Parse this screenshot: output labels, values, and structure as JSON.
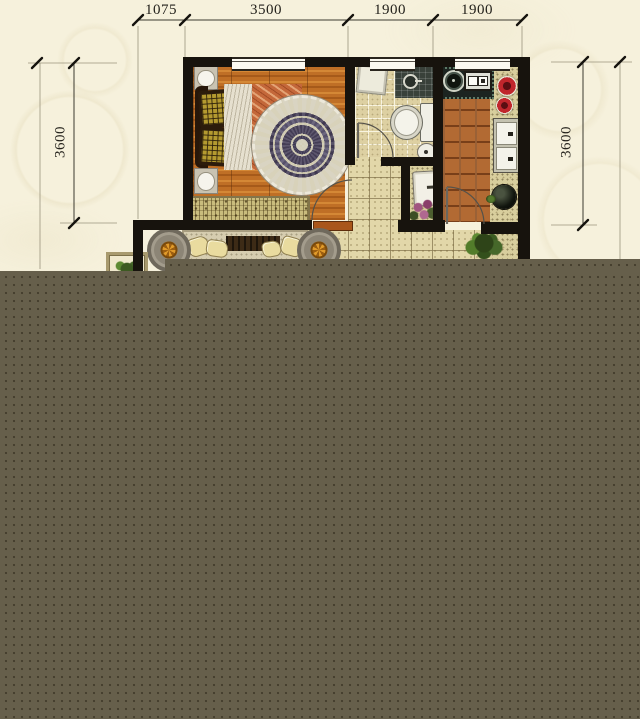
{
  "floor_plan": {
    "dimensions": {
      "top": [
        {
          "label": "1075"
        },
        {
          "label": "3500"
        },
        {
          "label": "1900"
        },
        {
          "label": "1900"
        }
      ],
      "left": {
        "label": "3600"
      },
      "right": {
        "label": "3600"
      }
    },
    "palette": {
      "background": "#f6f1dc",
      "wall": "#17130d",
      "overlay_block": "#665f4b",
      "wood_floor": "#bf6f26",
      "kitchen_tile": "#b26a33",
      "bath_tile": "#ddd0a2",
      "hall_tile": "#e2d7a9",
      "rug": "#443d55",
      "blanket": "#c4683a",
      "accent_red": "#c0262c",
      "planter_orange": "#e09a2a",
      "plant_green": "#2e4418",
      "dimension_text": "#24221c"
    }
  }
}
